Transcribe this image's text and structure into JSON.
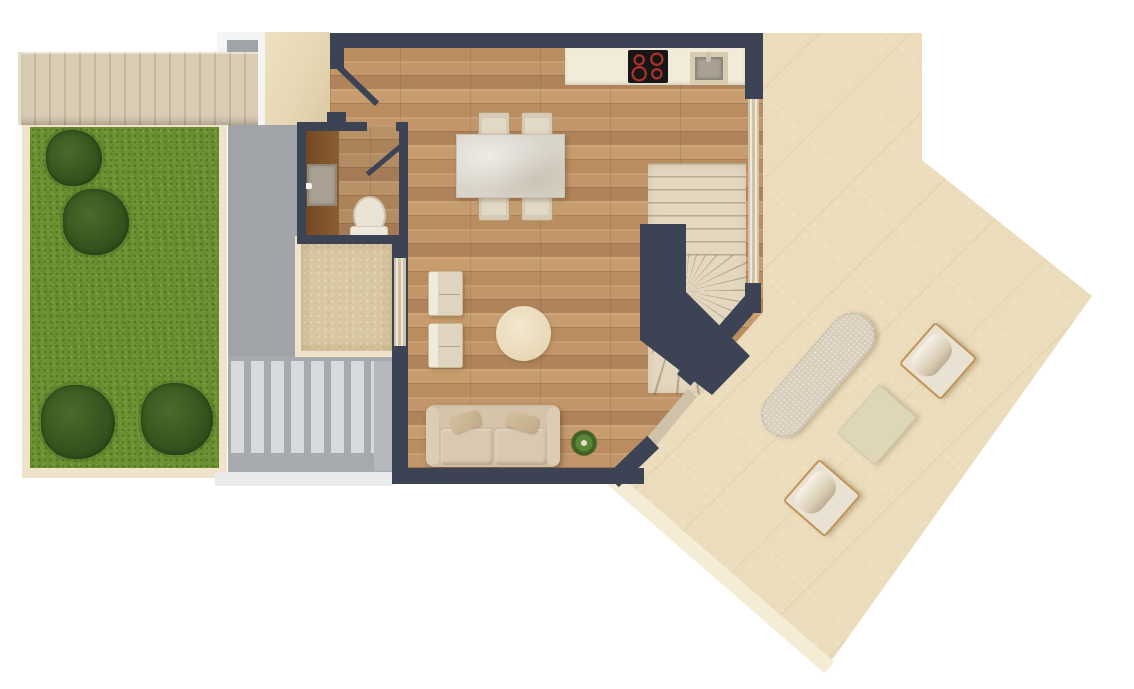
{
  "scene": {
    "type": "residential-floor-plan-top-view",
    "areas": [
      "garden-lawn",
      "exterior-staircase",
      "entry-landing",
      "side-paving",
      "deck-steps",
      "patio-court",
      "bathroom",
      "kitchen",
      "dining-area",
      "living-area",
      "winder-staircase",
      "roof-terrace"
    ],
    "furniture": [
      "cooktop",
      "kitchen-sink",
      "dining-table",
      "dining-chair",
      "armchair",
      "round-rug",
      "sofa",
      "potted-plant",
      "bathroom-vanity",
      "bathroom-sink",
      "toilet",
      "sun-lounger",
      "outdoor-armchair",
      "outdoor-table"
    ],
    "counts": {
      "exterior_stair_treads": 16,
      "deck_slat_steps": 8,
      "garden_bushes": 4,
      "dining_chairs": 4,
      "cooktop_burners": 4,
      "living_armchairs": 2,
      "outdoor_armchairs": 2
    },
    "palette": {
      "wall": "#3b4355",
      "wood": "#c49a6c",
      "wood-dark": "#b78c5e",
      "lawn": "#6d9233",
      "bush": "#34521e",
      "paving": "#a0a3a8",
      "slat": "#d8d9db",
      "stone": "#ebdcbb",
      "stone-edge": "#f5ecd6",
      "tread": "#d9ccb5",
      "tread-line": "#c3b49a",
      "landing": "#e8dbbb",
      "counter": "#f2ebd9",
      "cream": "#efe3cc",
      "patio": "#d9c7a1",
      "vanity": "#7b5129",
      "marble": "#d9d4c9",
      "burner": "#a8322a",
      "glass": "#e6dcc4"
    }
  }
}
